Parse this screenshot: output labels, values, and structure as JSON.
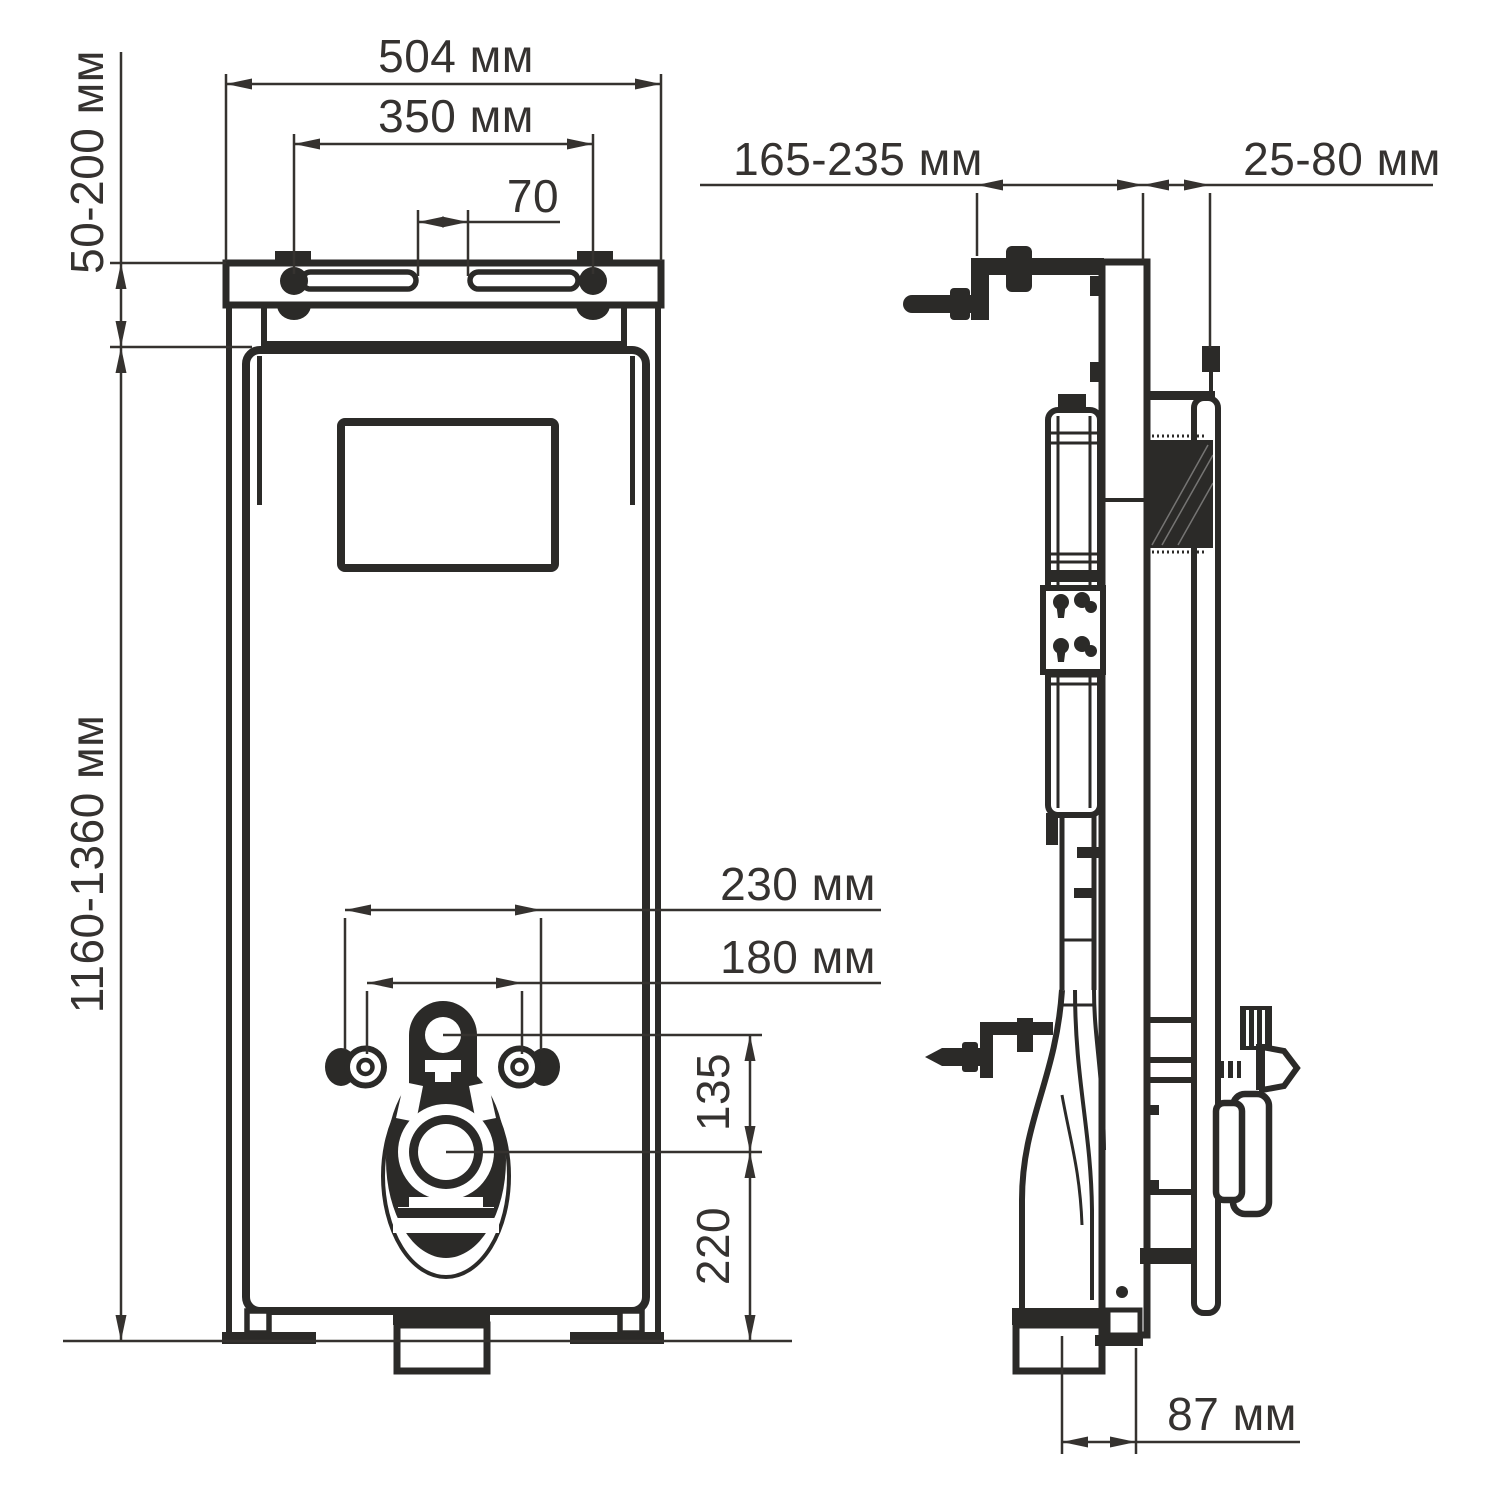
{
  "palette": {
    "line": "#2b2a28",
    "text": "#353230",
    "background": "#ffffff"
  },
  "front_view": {
    "dim_width": "504 мм",
    "dim_hanger_spacing": "350 мм",
    "dim_slot_gap": "70",
    "dim_top_clearance": "50-200 мм",
    "dim_height_range": "1160-1360 мм",
    "dim_fixing_span_outer": "230 мм",
    "dim_fixing_span_inner": "180 мм",
    "dim_flush_pipe_height": "135",
    "dim_outlet_height": "220"
  },
  "side_view": {
    "dim_frame_depth": "165-235 мм",
    "dim_wall_clearance": "25-80 мм",
    "dim_outlet_offset": "87 мм"
  }
}
